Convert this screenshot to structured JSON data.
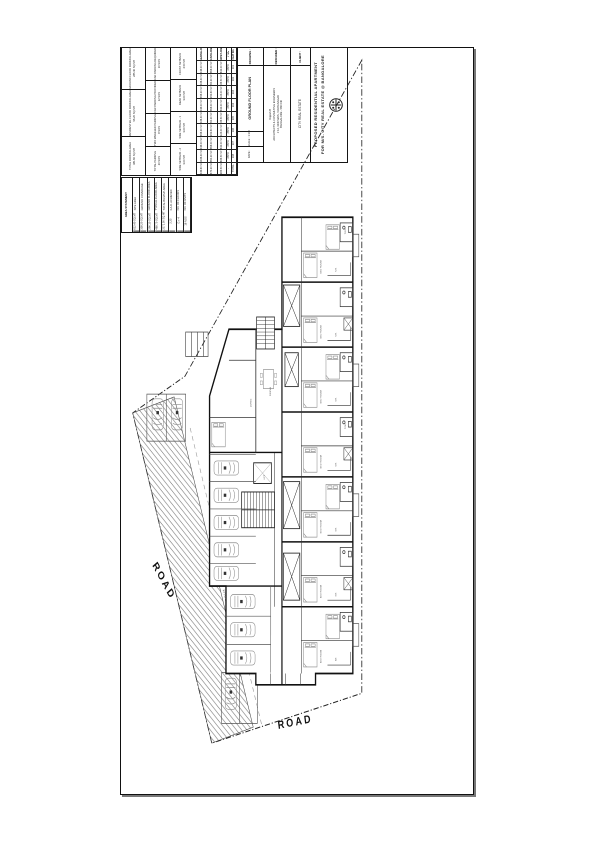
{
  "page": {
    "ink": "#1a1a1a"
  },
  "title_block": {
    "title_line1": "PROPOSED RESIDENTIAL APARTMENT",
    "title_line2": "FOR M/S. CITY REAL ESTATE @ BANGALORE",
    "client_label": "CLIENT :",
    "client_name": "CITY REAL ESTATE",
    "designer_label": "DESIGNER :",
    "designer_lines": [
      "Rajesh B",
      "ARCHITECTS & CONSULTING ENGINEERS",
      "# 12, 3RD MAIN, VIJAYANAGAR",
      "BANGALORE - 560 040"
    ],
    "drawing_label": "DRAWING :",
    "drawing_name": "GROUND FLOOR PLAN",
    "scale_label": "SCALE : 1:100",
    "date_label": "DATE :"
  },
  "tables": {
    "parking_area": {
      "rows": [
        {
          "k": "GROUND FLOOR PARKING AREA",
          "v": "285.40 SQ.MT"
        },
        {
          "k": "RESIDENTIAL FLOOR PARKING AREA",
          "v": "96.20 SQ.MT"
        },
        {
          "k": "TOTAL PARKING AREA",
          "v": "381.60 SQ.MT"
        }
      ]
    },
    "parking_count": {
      "rows": [
        {
          "k": "CAR PARKING REQUIRED",
          "v": "10 NOS"
        },
        {
          "k": "CAR PARKING PROVIDED",
          "v": "12 NOS"
        },
        {
          "k": "TWO WHEELER PARKING",
          "v": "8 NOS"
        },
        {
          "k": "TOTAL PARKING",
          "v": "20 NOS"
        }
      ]
    },
    "setbacks": {
      "rows": [
        {
          "k": "FRONT SETBACK",
          "v": "4.50 MT"
        },
        {
          "k": "REAR SETBACK",
          "v": "3.00 MT"
        },
        {
          "k": "SIDE SETBACK - 1",
          "v": "3.00 MT"
        },
        {
          "k": "SIDE SETBACK - 2",
          "v": "3.00 MT"
        }
      ]
    },
    "flat_table": {
      "header": [
        "SALEABLE AREA",
        "PLINTH AREA",
        "CARPET AREA",
        "TYPE",
        "FLAT NO."
      ],
      "rows": [
        [
          "1046.00 SFT",
          "968.00 SFT",
          "842.00 SFT",
          "2BHK",
          "101"
        ],
        [
          "1038.40 SFT",
          "960.20 SFT",
          "836.50 SFT",
          "2BHK",
          "102"
        ],
        [
          "1398.20 SFT",
          "1292.60 SFT",
          "1124.00 SFT",
          "3BHK",
          "103"
        ],
        [
          "1046.00 SFT",
          "968.00 SFT",
          "842.00 SFT",
          "2BHK",
          "104"
        ],
        [
          "1038.40 SFT",
          "960.20 SFT",
          "836.50 SFT",
          "2BHK",
          "105"
        ],
        [
          "1398.20 SFT",
          "1292.60 SFT",
          "1124.00 SFT",
          "3BHK",
          "106"
        ],
        [
          "1046.00 SFT",
          "968.00 SFT",
          "842.00 SFT",
          "2BHK",
          "107"
        ],
        [
          "1038.40 SFT",
          "960.20 SFT",
          "836.50 SFT",
          "2BHK",
          "108"
        ],
        [
          "9049.60 SFT",
          "8370.20 SFT",
          "7283.50 SFT",
          "-",
          "TOTAL"
        ]
      ]
    },
    "area_statement": {
      "title": "AREA STATEMENT",
      "cols": [
        {
          "k": "SITE AREA",
          "v": "612.40 SQ.MT"
        },
        {
          "k": "GROUND COVERAGE",
          "v": "358.20 SQ.MT"
        },
        {
          "k": "GROUND FLOOR AREA",
          "v": "296.10 SQ.MT"
        },
        {
          "k": "TYPICAL FLOOR AREA",
          "v": "468.70 SQ.MT"
        },
        {
          "k": "TOTAL BUILTUP AREA",
          "v": "2171.00 SQ.MT"
        },
        {
          "k": "F.A.R. ACHIEVED",
          "v": "2.25"
        },
        {
          "k": "NO. OF FLOORS",
          "v": "G + 4"
        },
        {
          "k": "NO. OF UNITS",
          "v": "16 NOS"
        }
      ]
    }
  },
  "plan": {
    "road_left": "ROAD",
    "road_bottom": "ROAD",
    "driveway_label": "6.0 MT WIDE DRIVE WAY",
    "labels": {
      "bed": "BED ROOM",
      "kit": "KIT.",
      "toilet": "TOIL.",
      "lift": "LIFT",
      "living": "LIVING",
      "dining": "DINING"
    }
  }
}
